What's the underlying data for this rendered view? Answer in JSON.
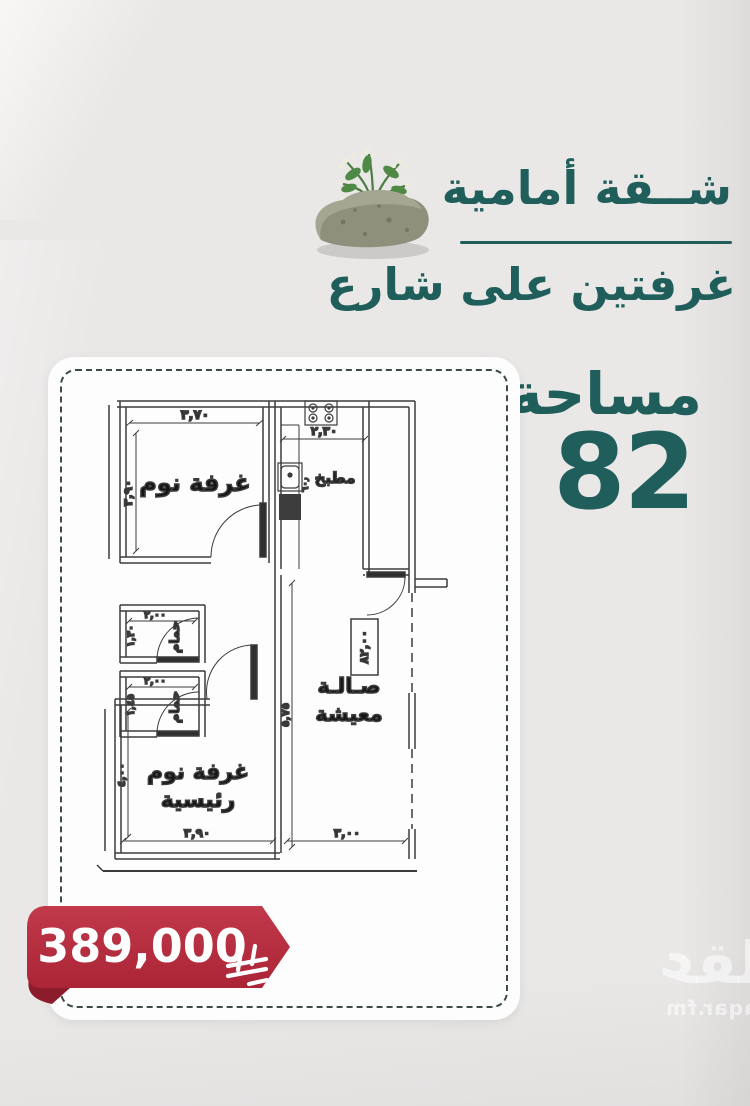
{
  "colors": {
    "accent_teal": "#1f5e5a",
    "price_red": "#b62d3e",
    "price_red_dark": "#8c1b2c",
    "plan_line": "#3c3c3c"
  },
  "header": {
    "title": "شــقة أمامية",
    "subtitle": "غرفتين على شارع",
    "area_label": "مساحة",
    "area_value": "82"
  },
  "floorplan": {
    "bedroom1_label": "غرفة نوم",
    "kitchen_label": "مطبخ",
    "bath1_label": "حمام",
    "bath2_label": "حمام",
    "master_label_line1": "غرفة نوم",
    "master_label_line2": "رئيسية",
    "living_label_line1": "صـالـة",
    "living_label_line2": "معيشة",
    "dims": {
      "bedroom1_width": "٣,٧٠",
      "bedroom1_depth": "٣,٩٠",
      "kitchen_width": "٢,٣٠",
      "counter_width": "٦٠٫",
      "bath1_width": "٢,٠٠",
      "bath1_depth": "١,٣٠",
      "bath2_width": "٢,٠٠",
      "bath2_depth": "١,٤٥",
      "master_width": "٣,٩٠",
      "master_depth": "٤,٠٠",
      "living_width": "٣,٠٠",
      "living_depth": "٥,٧٥",
      "total_area": "٨٢,٠٠"
    }
  },
  "price": {
    "amount": "389,000"
  },
  "watermark": {
    "logo_text": "عقار",
    "site_text": "sa.aqar.fm"
  }
}
